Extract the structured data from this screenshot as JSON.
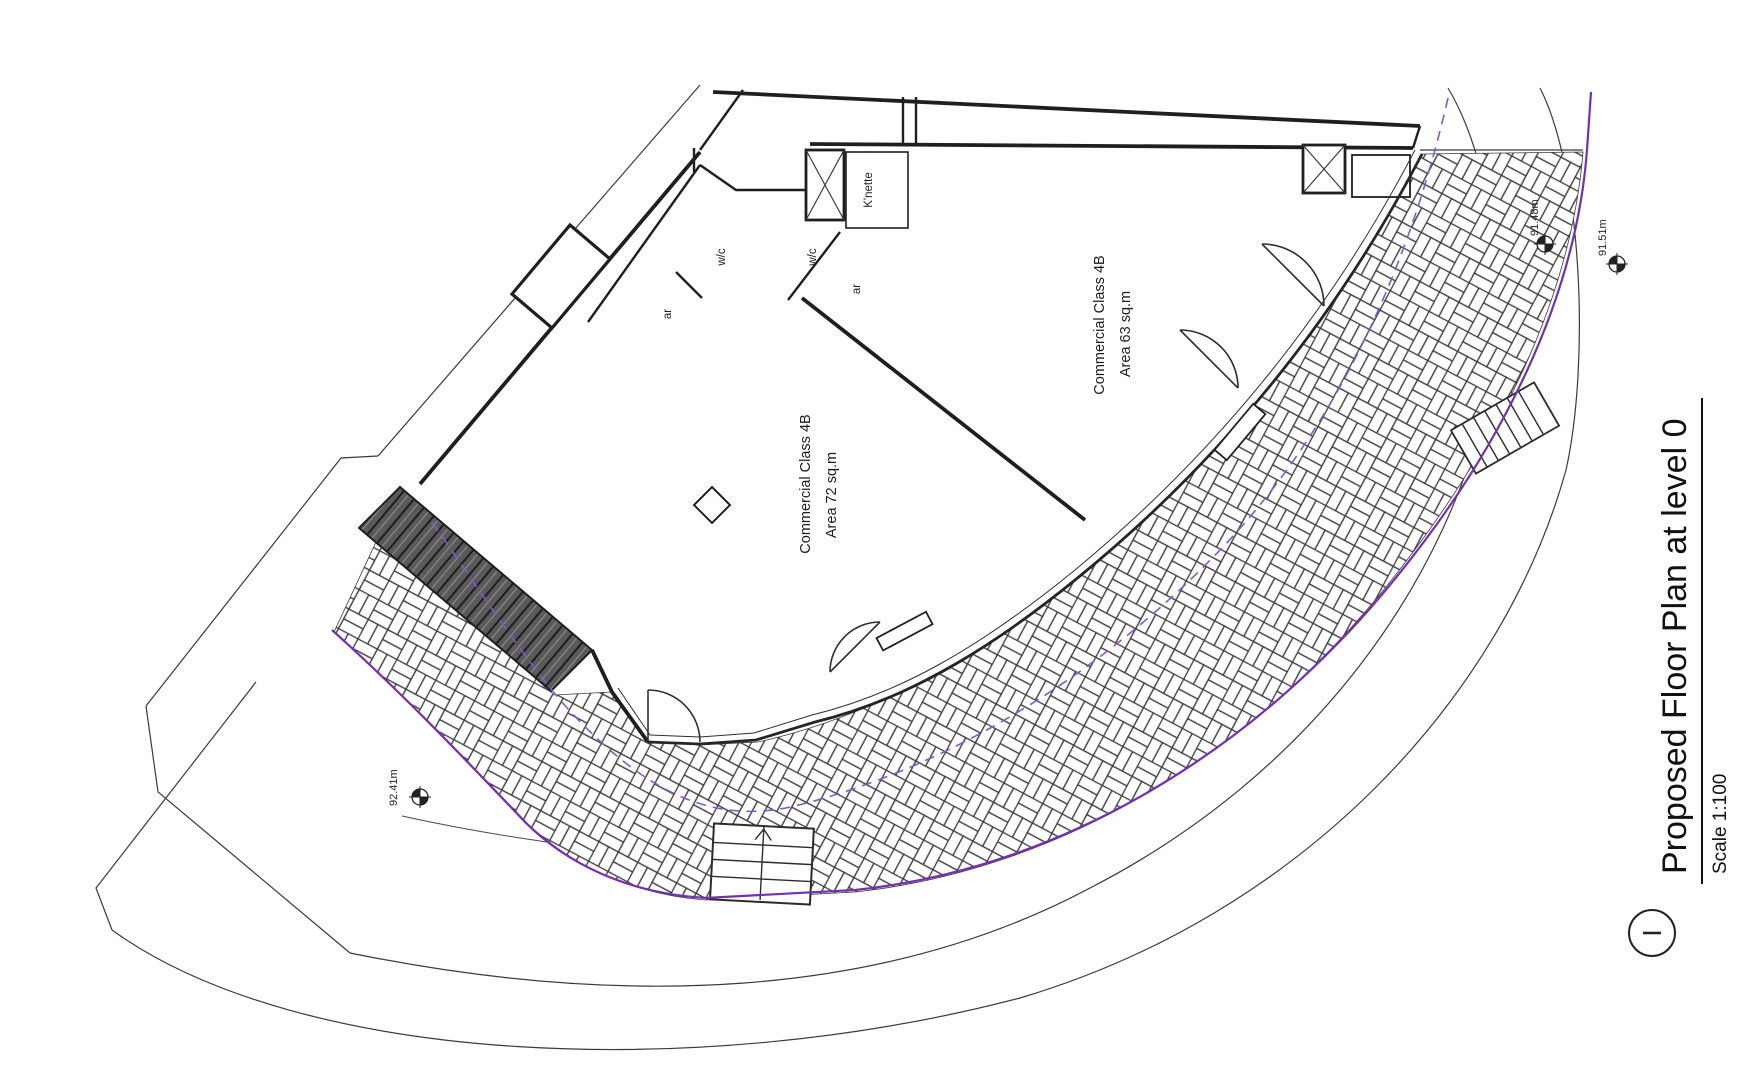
{
  "drawing": {
    "title": "Proposed Floor Plan at level 0",
    "scale_label": "Scale 1:100",
    "rooms": [
      {
        "name_line": "Commercial Class 4B",
        "area_line": "Area 72 sq.m"
      },
      {
        "name_line": "Commercial Class 4B",
        "area_line": "Area 63 sq.m"
      }
    ],
    "small_rooms": {
      "wc_left": "w/c",
      "wc_right": "w/c",
      "ar_left": "ar",
      "ar_right": "ar",
      "kitchenette": "K'nette"
    },
    "levels": [
      {
        "value": "92.41m"
      },
      {
        "value": "91.48m"
      },
      {
        "value": "91.51m"
      }
    ],
    "colors": {
      "boundary_purple_solid": "#7430b0",
      "boundary_purple_dashed": "#8a55c8",
      "line_black": "#2e2e2e",
      "ramp_fill": "#5a5a5a"
    }
  }
}
